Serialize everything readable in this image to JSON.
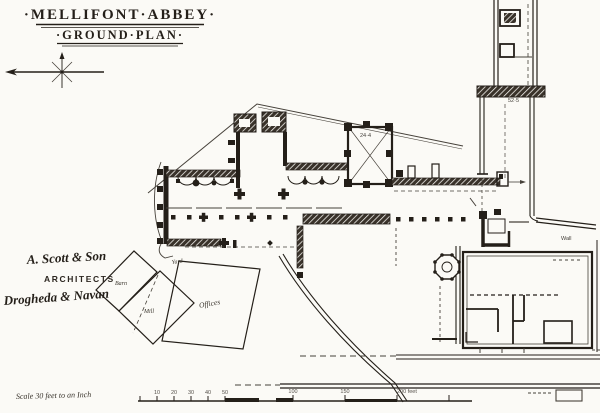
{
  "document": {
    "kind": "scanned architectural ground plan",
    "paper_color": "#fbfaf6",
    "ink_color": "#241f19"
  },
  "title": {
    "line1": "·MELLIFONT·ABBEY·",
    "line2": "·GROUND·PLAN·"
  },
  "architect_inscription": {
    "name": "A. Scott & Son",
    "role": "ARCHITECTS",
    "towns": "Drogheda & Navan"
  },
  "plan_labels": {
    "barn": "Barn",
    "mill": "Mill",
    "offices": "Offices",
    "yard": "Yard",
    "wall": "Wall"
  },
  "dimensions": {
    "east_wall": "52·5",
    "tower": "24·4"
  },
  "scale_bar": {
    "caption": "Scale 30 feet to an Inch",
    "tick_labels": [
      "10",
      "20",
      "30",
      "40",
      "50",
      "100",
      "150",
      "200 feet"
    ]
  },
  "icons": {
    "north_arrow": "compass-north-arrow"
  }
}
